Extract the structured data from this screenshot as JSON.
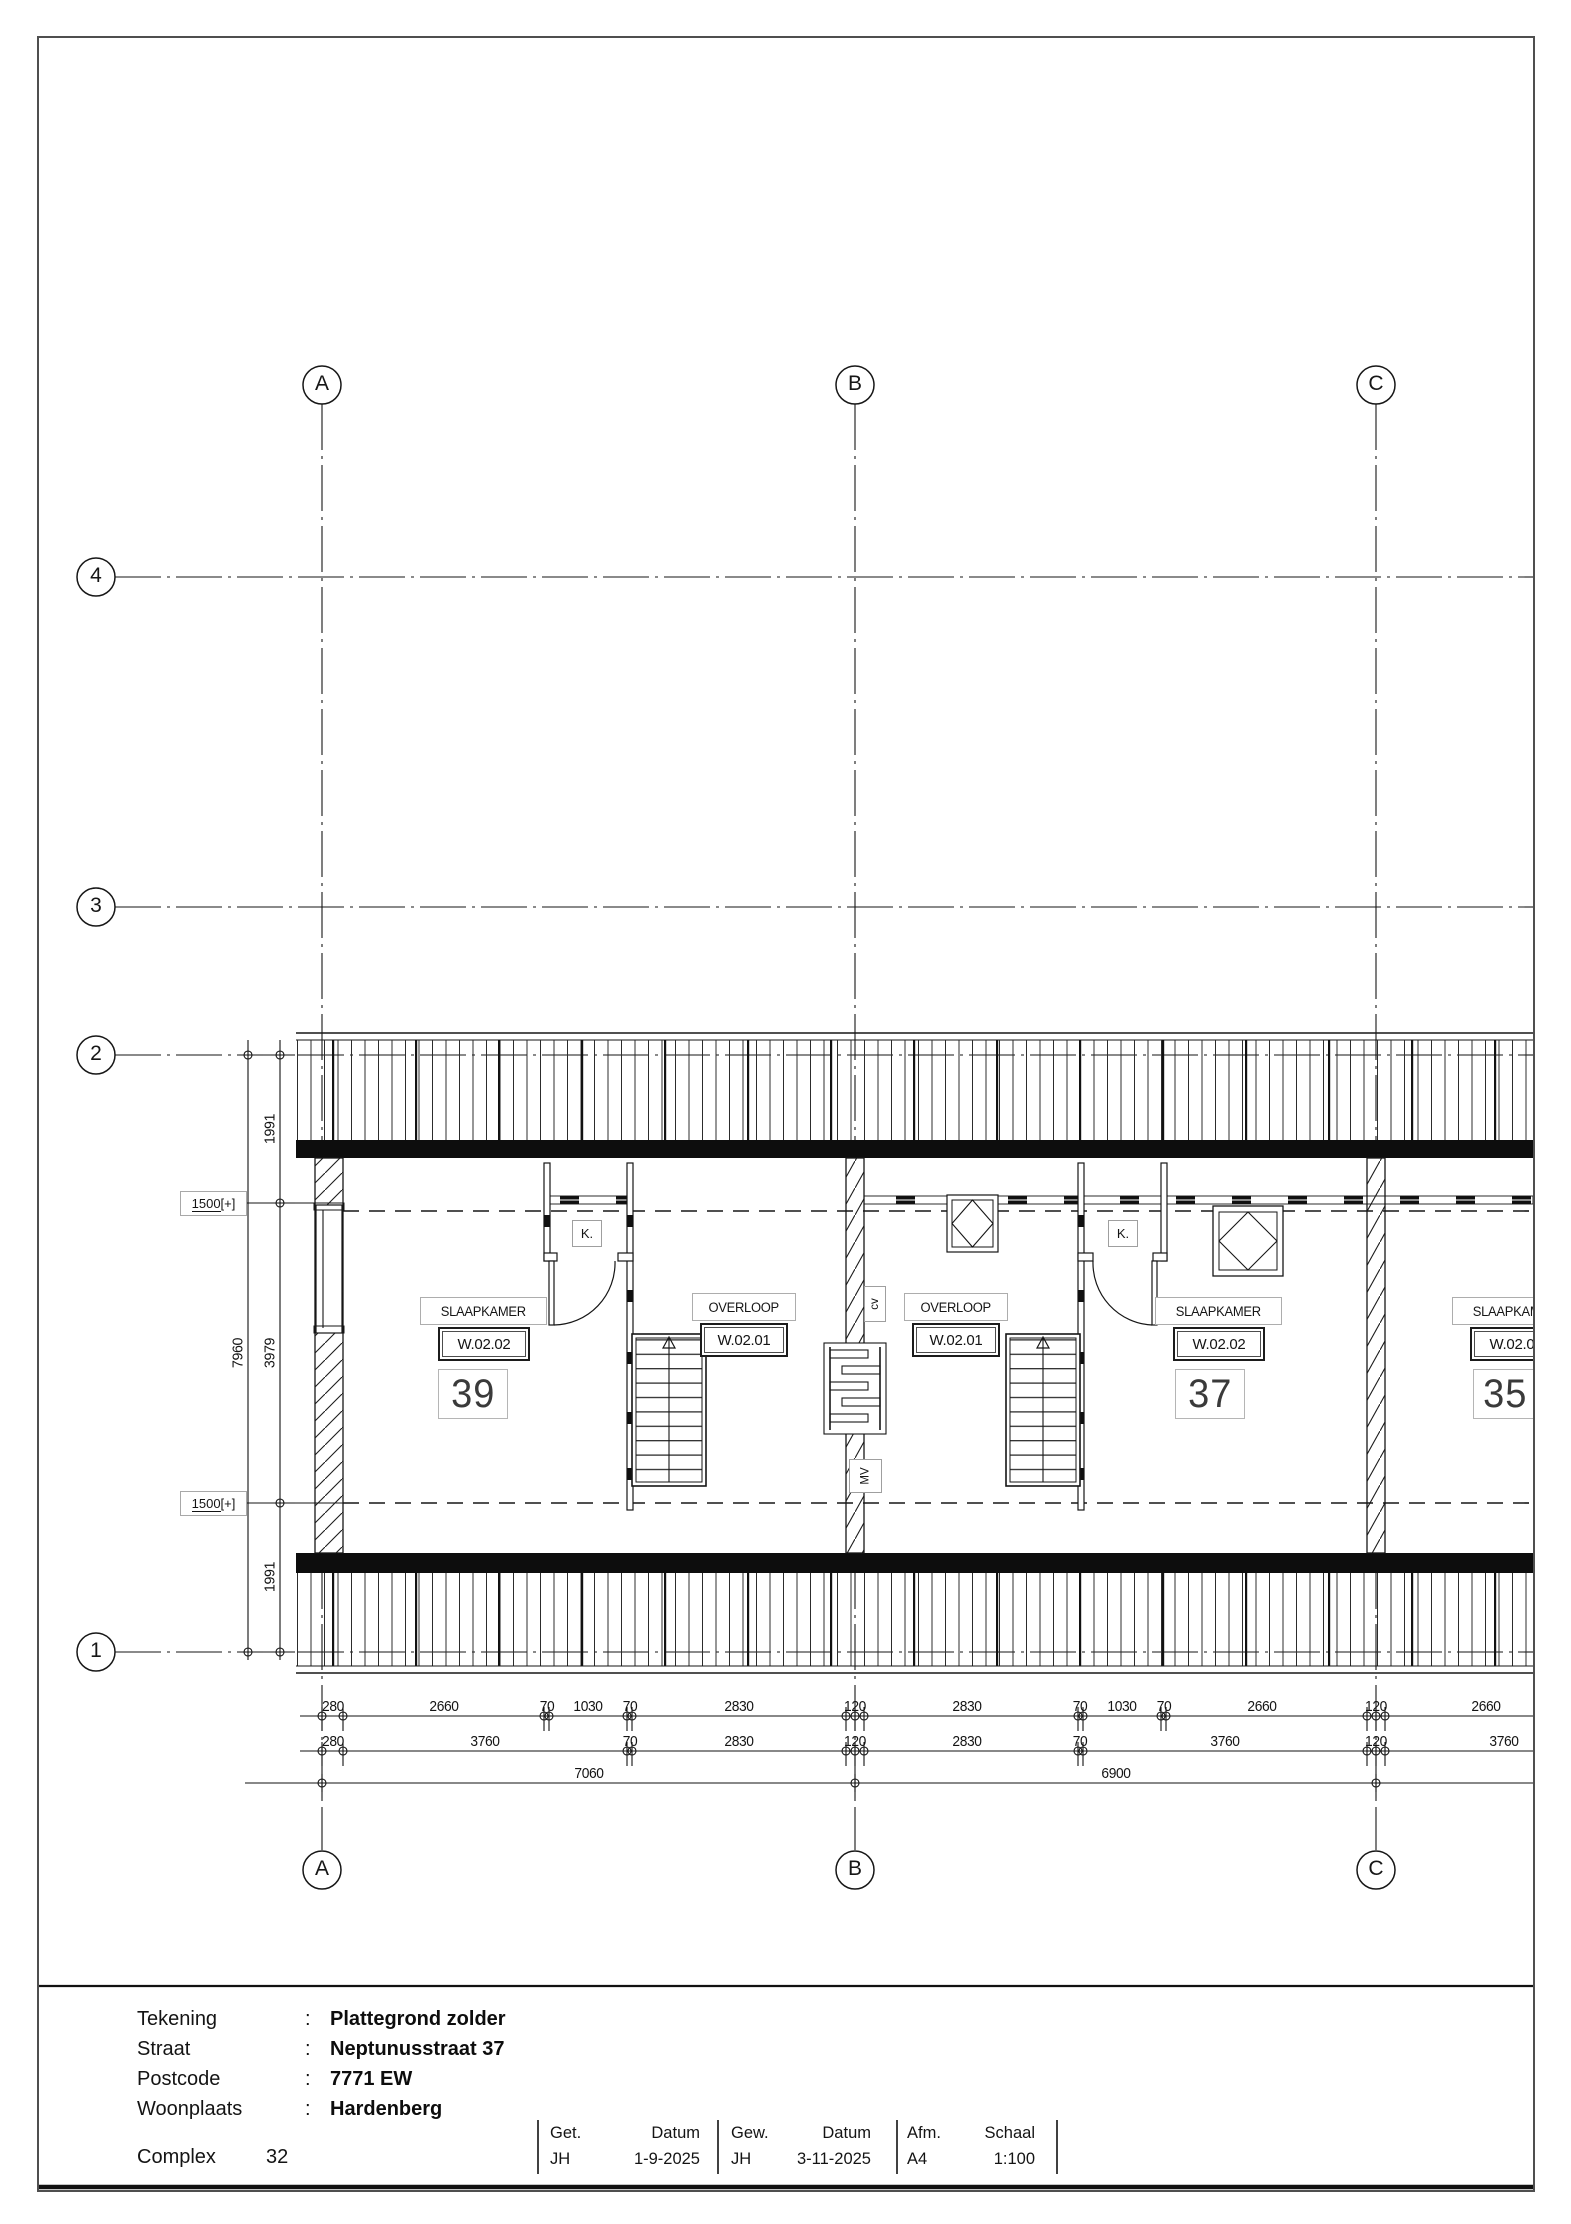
{
  "sheet": {
    "grid": {
      "columns": [
        "A",
        "B",
        "C"
      ],
      "rows": [
        "4",
        "3",
        "2",
        "1"
      ]
    },
    "plan": {
      "rooms": [
        {
          "name": "SLAAPKAMER",
          "code": "W.02.02",
          "number": "39"
        },
        {
          "name": "OVERLOOP",
          "code": "W.02.01"
        },
        {
          "name": "OVERLOOP",
          "code": "W.02.01"
        },
        {
          "name": "SLAAPKAMER",
          "code": "W.02.02",
          "number": "37"
        },
        {
          "name": "SLAAPKAMER",
          "code": "W.02.02",
          "number": "35"
        }
      ],
      "closet_label": "K.",
      "cv_label": "cv",
      "mv_label": "MV",
      "height_marker": {
        "value": "1500",
        "suffix": "[+]"
      }
    },
    "dimensions": {
      "row1": [
        "280",
        "2660",
        "70",
        "1030",
        "70",
        "2830",
        "120",
        "2830",
        "70",
        "1030",
        "70",
        "2660",
        "120",
        "2660"
      ],
      "row2": [
        "280",
        "3760",
        "70",
        "2830",
        "120",
        "2830",
        "70",
        "3760",
        "120",
        "3760"
      ],
      "row3": [
        "7060",
        "6900"
      ],
      "vertical_inner": [
        "1991",
        "3979",
        "1991"
      ],
      "vertical_outer": [
        "7960"
      ]
    },
    "title_block": {
      "colon": ":",
      "fields": [
        {
          "label": "Tekening",
          "value": "Plattegrond zolder"
        },
        {
          "label": "Straat",
          "value": "Neptunusstraat 37"
        },
        {
          "label": "Postcode",
          "value": "7771 EW"
        },
        {
          "label": "Woonplaats",
          "value": "Hardenberg"
        }
      ],
      "complex_label": "Complex",
      "complex_value": "32",
      "stamp": {
        "get_label": "Get.",
        "datum_label": "Datum",
        "gew_label": "Gew.",
        "afm_label": "Afm.",
        "schaal_label": "Schaal",
        "get_value": "JH",
        "get_datum": "1-9-2025",
        "gew_value": "JH",
        "gew_datum": "3-11-2025",
        "afm_value": "A4",
        "schaal_value": "1:100"
      }
    }
  }
}
